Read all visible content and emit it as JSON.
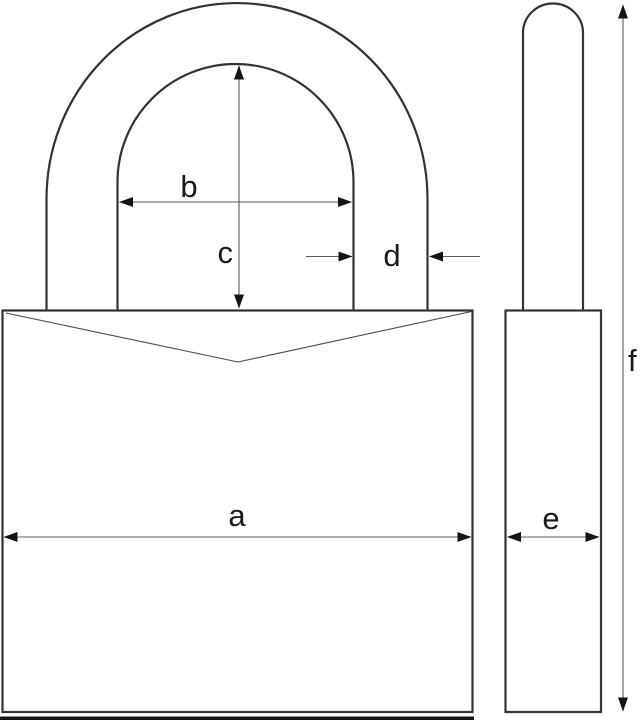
{
  "diagram": {
    "labels": {
      "a": "a",
      "b": "b",
      "c": "c",
      "d": "d",
      "e": "e",
      "f": "f"
    },
    "colors": {
      "background": "#ffffff",
      "outline": "#333333",
      "notch_line": "#4a4a4a",
      "dimension_line": "#5a5a5a",
      "arrowhead": "#141414",
      "label": "#1a1a1a",
      "bottom_edge": "#141414"
    }
  }
}
